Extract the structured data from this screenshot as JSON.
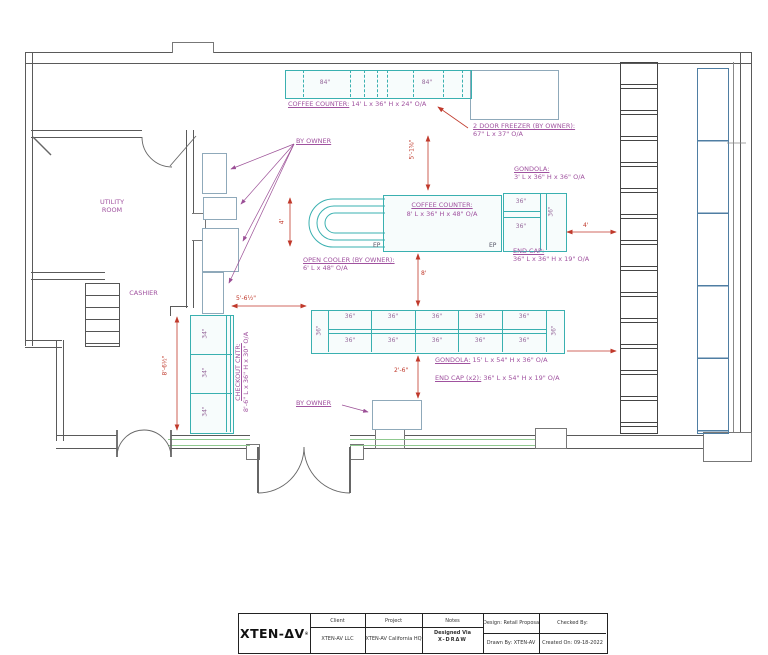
{
  "plan": {
    "rooms": {
      "utility_line1": "UTILITY",
      "utility_line2": "ROOM",
      "cashier": "CASHIER"
    },
    "fixtures": {
      "coffee_counter_top": {
        "label": "COFFEE COUNTER:",
        "spec": "14' L x 36\" H x 24\" O/A",
        "section_labels": [
          "84\"",
          "84\""
        ]
      },
      "freezer": {
        "label": "2 DOOR FREEZER (BY OWNER):",
        "spec": "67\" L x 37\" O/A"
      },
      "gondola_small": {
        "label": "GONDOLA:",
        "spec": "3' L x 36\" H x 36\" O/A",
        "cells": [
          "36\"",
          "36\"",
          "36\""
        ]
      },
      "coffee_counter_island": {
        "label": "COFFEE COUNTER:",
        "spec": "8' L x 36\" H x 48\" O/A",
        "ep_left": "EP",
        "ep_right": "EP"
      },
      "end_cap_small": {
        "label": "END CAP:",
        "spec": "36\" L x 36\" H x 19\" O/A"
      },
      "open_cooler": {
        "label": "OPEN COOLER (BY OWNER):",
        "spec": "6' L x 48\" O/A"
      },
      "gondola_long": {
        "label": "GONDOLA:",
        "spec": "15' L x 54\" H x 36\" O/A",
        "cells": [
          "36\"",
          "36\"",
          "36\"",
          "36\"",
          "36\"",
          "36\"",
          "36\"",
          "36\"",
          "36\"",
          "36\""
        ],
        "ends": [
          "36\"",
          "36\""
        ]
      },
      "end_cap_long": {
        "label": "END CAP (x2):",
        "spec": "36\" L x 54\" H x 19\" O/A"
      },
      "checkout": {
        "label": "CHECKOUT CNTR:",
        "spec": "8'-6\" L x 36\" H x 30\" O/A",
        "cells": [
          "34\"",
          "34\"",
          "34\""
        ]
      },
      "by_owner_top": "BY OWNER",
      "by_owner_bottom": "BY OWNER"
    },
    "dimensions": {
      "gap_freezer": "5'-1⅝\"",
      "cooler_depth": "4'",
      "aisle_mid": "8'",
      "aisle_rear": "2'-6\"",
      "front_gap": "5'-6½\"",
      "checkout_length": "8'-6½\"",
      "endcap_to_wall": "4'"
    }
  },
  "title_block": {
    "logo": "XTEN-ΔV",
    "logo_mark": "®",
    "client_label": "Client",
    "client": "XTEN-AV LLC",
    "project_label": "Project",
    "project": "XTEN-AV California HQ",
    "notes_label": "Notes",
    "designed_via": "Designed Via",
    "xdraw": "X-DRΔW",
    "design": "Design:  Retail Proposal",
    "checked_by": "Checked By:",
    "drawn_by": "Drawn By: XTEN-AV",
    "created_on": "Created On: 09-18-2022"
  }
}
